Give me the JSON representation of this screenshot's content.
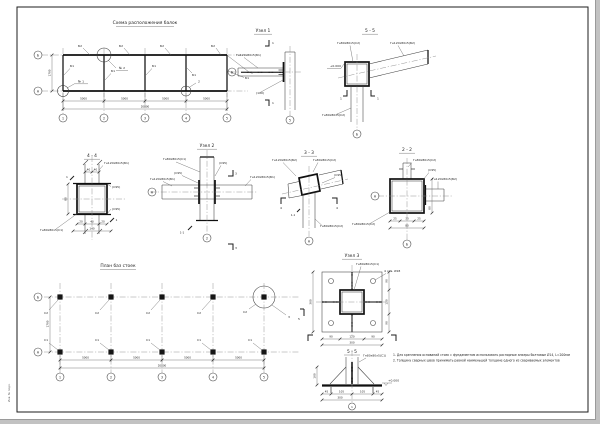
{
  "sheet": {
    "margin_stamp": "Инв. № подл."
  },
  "axes": {
    "letters": [
      "Б",
      "А"
    ],
    "numbers": [
      "1",
      "2",
      "3",
      "4",
      "5"
    ]
  },
  "dims": {
    "bay": "5000",
    "total": "20000",
    "height": "1700"
  },
  "profiles": {
    "c1": "Гн80х80х5(С1)",
    "c2": "Гн80х80х5(С2)",
    "b1": "Гн120х80х5(Б1)",
    "b2": "Гн120х80х5(Б2)"
  },
  "marks": {
    "weld": "(С95)",
    "note100": "(100)",
    "level": "+0.000",
    "cut11": "1-1"
  },
  "scheme": {
    "title": "Схема расположения балок",
    "beam_top": "Б2",
    "beam_inner": "Б1",
    "node1": "№ 1",
    "node2": "№ 2",
    "callout1": "1",
    "callout2": "2"
  },
  "node1": {
    "title": "Узел 1",
    "cut": "1"
  },
  "sec55top": {
    "title": "5 - 5",
    "cut": "1"
  },
  "sec44": {
    "title": "4 - 4",
    "cut": "1",
    "d20": "20",
    "d40": "40",
    "d80": "80",
    "d140": "140"
  },
  "node2": {
    "title": "Узел 2",
    "cut": "3"
  },
  "sec33": {
    "title": "3 - 3",
    "cut": "4"
  },
  "sec22": {
    "title": "2 - 2",
    "d25": "25",
    "d30": "30",
    "d80": "80"
  },
  "plan": {
    "title": "План баз стоек",
    "post_top": "С2",
    "post_bottom": "С1",
    "callout": "3",
    "cut": "5"
  },
  "node3": {
    "title": "Узел 3",
    "holes": "4 отв. Ø18",
    "d90": "90",
    "d120": "120",
    "d300": "300"
  },
  "sec55bot": {
    "title": "5 - 5",
    "d45": "45",
    "d105": "105",
    "d300": "300",
    "d100": "100",
    "axis1": "1"
  },
  "notes": {
    "line1": "1. Для крепления оснований стоек с фундаментом использовать распорные анкеры болтовые Ø14, L=200мм",
    "line2": "2. Толщину сварных швов принимать равной наименьшей толщине одного из свариваемых элементов"
  }
}
